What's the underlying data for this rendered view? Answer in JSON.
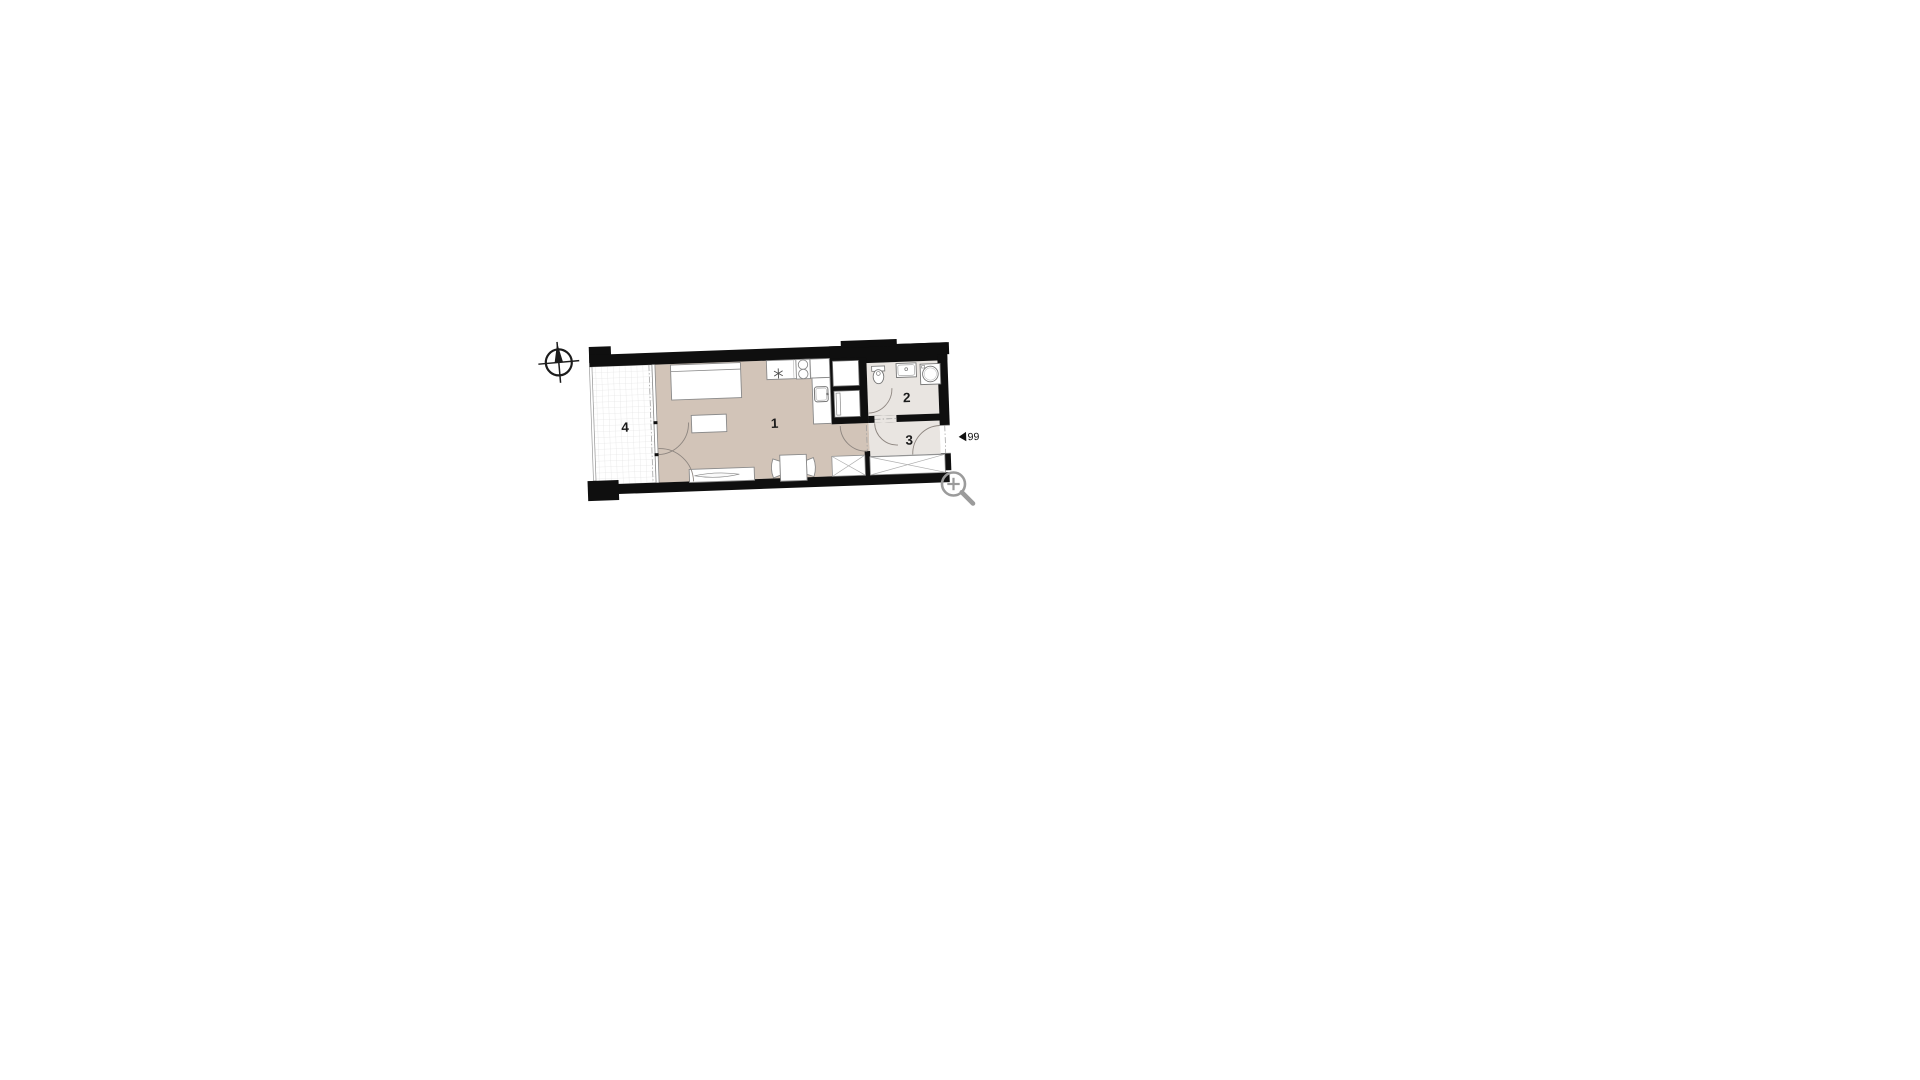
{
  "page": {
    "background": "#ffffff",
    "type": "floor-plan-drawing"
  },
  "plan": {
    "rooms": [
      {
        "id": "room-1",
        "label": "1",
        "floor": "living"
      },
      {
        "id": "room-2",
        "label": "2",
        "floor": "wet"
      },
      {
        "id": "room-3",
        "label": "3",
        "floor": "wet"
      },
      {
        "id": "room-4",
        "label": "4",
        "floor": "balcony"
      }
    ],
    "unit_marker": {
      "number": "99"
    },
    "icons": [
      "compass-icon",
      "zoom-icon"
    ],
    "colors": {
      "wall": "#0f0f0f",
      "floor_living": "#d2c4b8",
      "floor_wet": "#e9e5e1",
      "floor_balcony": "#ffffff",
      "balcony_grid": "#dcdcdc",
      "furniture_stroke": "#8a8a8a",
      "door_arc": "#8e8680",
      "magnifier": "#9b9b9b",
      "compass": "#1c1c1c"
    }
  }
}
